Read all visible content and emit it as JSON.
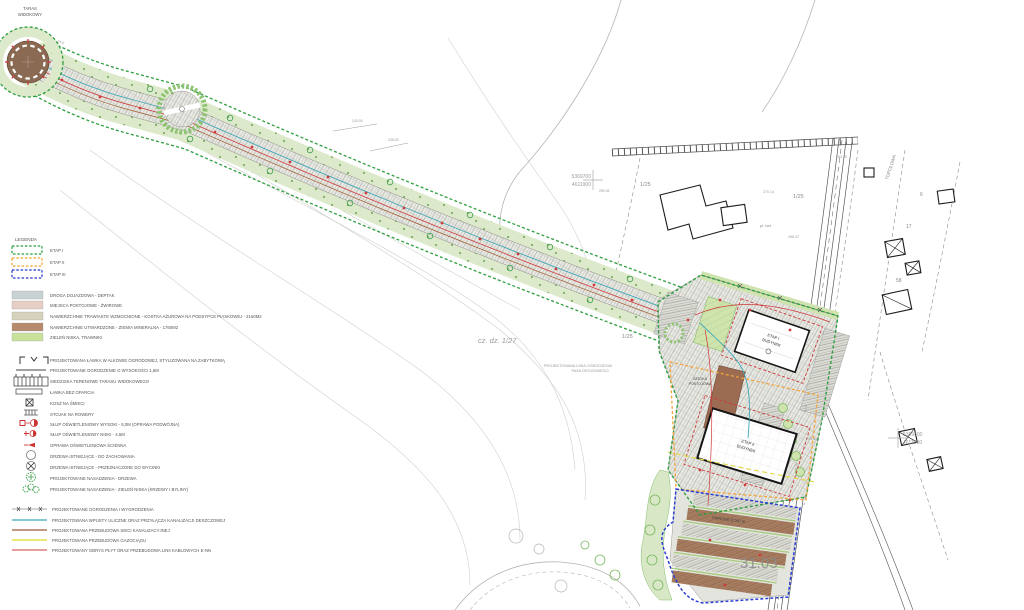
{
  "map": {
    "labels": {
      "taras_1": "TARAS",
      "taras_2": "WIDOKOWY",
      "parcel_main": "cz. dz. 1/27",
      "parcel_25a": "1/25",
      "parcel_25b": "1/25",
      "parcel_25c": "1/25",
      "parcel_17": "17",
      "parcel_58": "58",
      "parcel_6": "6",
      "bldg1_l1": "ETAP I",
      "bldg1_l2": "BUDYNEK",
      "bldg2_l1": "ETAP II",
      "bldg2_l2": "BUDYNEK",
      "bay_1": "ZATOKA",
      "bay_2": "POSTOJOWA",
      "parking3": "PARKING ETAP III",
      "fence_note_1": "PROJEKTOWANA LINIA OGRODZENIA",
      "fence_note_2": "PASA DROGOWEGO",
      "date_mark": "31.03",
      "coord1_e": "5369700",
      "coord1_n": "4611900",
      "coord2_e": "5369500",
      "coord2_n": "4611900",
      "elev_1": "259.05",
      "elev_2": "270.14",
      "elev_3": "268.47",
      "elev_4": "249.50",
      "elev_5": "263.25",
      "note_plbet": "pł. bet.",
      "street": "TOPOLOWA",
      "contour_a": "240,00",
      "contour_b": "238,50",
      "dim_a": "24,0",
      "dim_b": "3,50",
      "dim_c": "6,00"
    }
  },
  "legend": {
    "title": "LEGENDA",
    "stages": [
      {
        "label": "ETAP I",
        "color": "#22a03c"
      },
      {
        "label": "ETAP II",
        "color": "#f0a32e"
      },
      {
        "label": "ETAP III",
        "color": "#2636cc"
      }
    ],
    "surfaces": [
      {
        "label": "DROGA DOJAZDOWA - DEPTAK",
        "color": "#c8d1d3"
      },
      {
        "label": "MIEJSCA POSTOJOWE - ŻWIROWE",
        "color": "#e7cfc7"
      },
      {
        "label": "NAWIERZCHNIE TRAWIASTE WZMOCNIONE - KOSTKA AŻUROWA NA PODSYPCE PIASKOWEJ - 2160M2",
        "color": "#d6d2bb"
      },
      {
        "label": "NAWIERZCHNIE UTWARDZONE - ZIEMIA MINERALNA - 1760M2",
        "color": "#b78a6e"
      },
      {
        "label": "ZIELEŃ NISKA, TRAWNIKI",
        "color": "#c8e29c"
      }
    ],
    "symbols": [
      {
        "label": "PROJEKTOWANA ŁAWKA W ALKOWIE OGRODOWEJ, STYLIZOWANA NA ZABYTKOWĄ"
      },
      {
        "label": "PROJEKTOWANE OGRODZENIE O WYSOKOŚCI 1,5M"
      },
      {
        "label": "SIEDZISKA TERENOWE TARASU WIDOKOWEGO"
      },
      {
        "label": "ŁAWKA BEZ OPARCIA"
      },
      {
        "label": "KOSZ NA ŚMIECI"
      },
      {
        "label": "STOJAK NA ROWERY"
      },
      {
        "label": "SŁUP OŚWIETLENIOWY WYSOKI - 8,0M (OPRAWA PODWÓJNA)"
      },
      {
        "label": "SŁUP OŚWIETLENIOWY NISKI - 4,5M"
      },
      {
        "label": "OPRAWA OŚWIETLENIOWA ŚCIENNA"
      },
      {
        "label": "DRZEWA ISTNIEJĄCE - DO ZACHOWANIA"
      },
      {
        "label": "DRZEWA ISTNIEJĄCE - PRZEZNACZONE DO WYCINKI"
      },
      {
        "label": "PROJEKTOWANE NASADZENIA - DRZEWA"
      },
      {
        "label": "PROJEKTOWANE NASADZENIA - ZIELEŃ NISKA (KRZEWY I BYLINY)"
      }
    ],
    "lines": [
      {
        "label": "PROJEKTOWANE OGRODZENIA I WYGRODZENIA",
        "color": "#8a8a8a"
      },
      {
        "label": "PROJEKTOWANA WPUSTY ULICZNE ORAZ PRZYŁĄCZA KANALIZACJI DESZCZOWEJ",
        "color": "#3fa8b8"
      },
      {
        "label": "PROJEKTOWANA PRZEBUDOWA SIECI KANALIZACYJNEJ",
        "color": "#9e5a3c"
      },
      {
        "label": "PROJEKTOWANA PRZEBUDOWA GAZOCIĄGU",
        "color": "#e8e04a"
      },
      {
        "label": "PROJEKTOWANY OBRYS PŁYT ORAZ PRZEBUDOWA LINII KABLOWYCH E-NN",
        "color": "#d23b3b"
      }
    ]
  }
}
